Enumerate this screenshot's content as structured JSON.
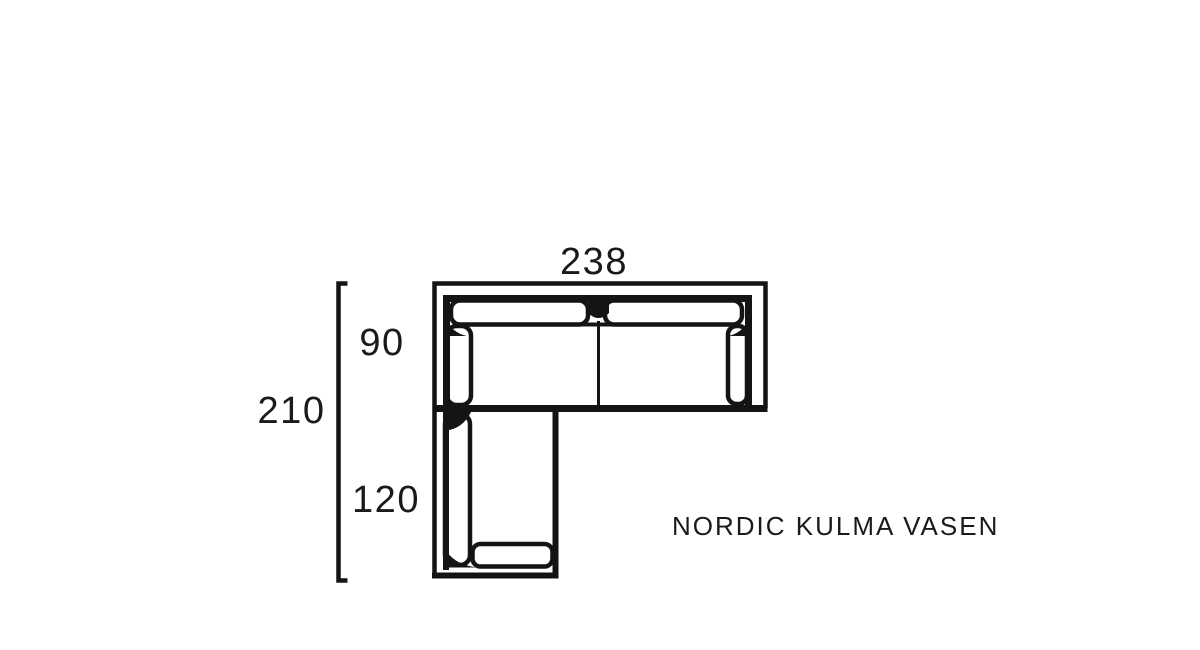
{
  "page": {
    "background_color": "#ffffff",
    "line_color": "#141414",
    "text_color": "#1a1a1a"
  },
  "diagram": {
    "product_name": "NORDIC KULMA VASEN",
    "dimensions": {
      "total_width": "238",
      "total_depth": "210",
      "sofa_section_depth": "90",
      "chaise_section_depth": "120"
    }
  }
}
